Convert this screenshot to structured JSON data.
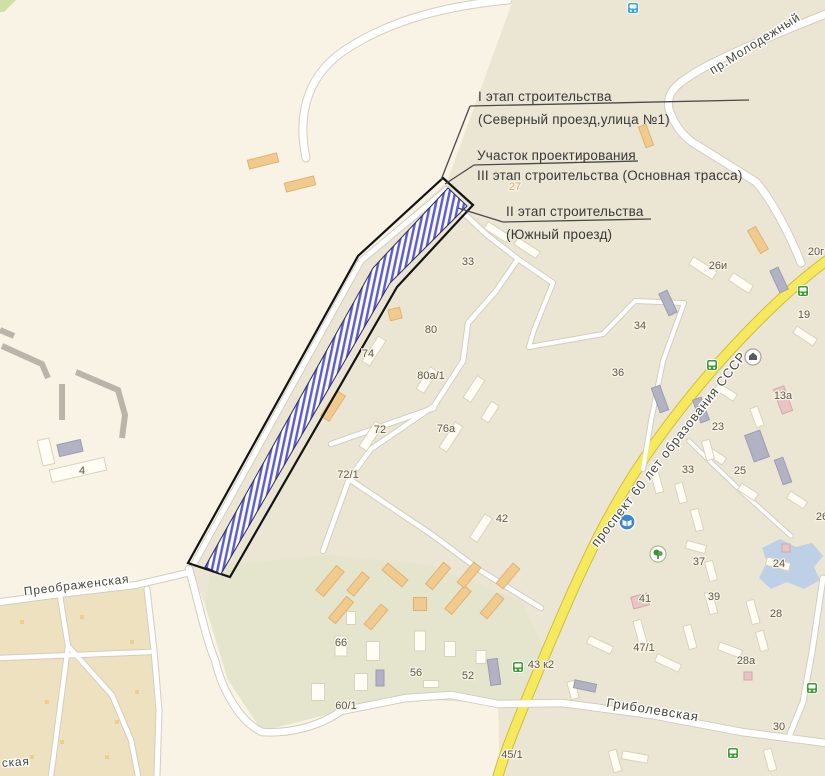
{
  "map": {
    "colors": {
      "background": "#f8f3e4",
      "district_beige": "#ebe6d4",
      "garage_olive": "#e5e4cc",
      "garden_tan": "#eee1c0",
      "road_fill": "#ffffff",
      "road_casing": "#d2cdbf",
      "highway_fill": "#f6e95e",
      "highway_casing": "#cdbd45",
      "pond_blue": "#b9cde8",
      "hatch_blue": "#5c5cd0",
      "corridor_outline": "#141414",
      "green_corner": "#cfe0a6"
    },
    "street_labels": [
      {
        "text": "пр.Молодежный",
        "x": 757,
        "y": 47,
        "rot": -32,
        "size": 12.5
      },
      {
        "text": "проспект 60 лет образования СССР",
        "x": 672,
        "y": 452,
        "rot": -52,
        "size": 13
      },
      {
        "text": "Гриболевская",
        "x": 652,
        "y": 714,
        "rot": 9,
        "size": 13
      },
      {
        "text": "Преображенская",
        "x": 77,
        "y": 589,
        "rot": -7,
        "size": 12
      },
      {
        "text": "ская",
        "x": 16,
        "y": 766,
        "rot": -4,
        "size": 12
      }
    ],
    "building_labels": [
      {
        "text": "27",
        "x": 515,
        "y": 190,
        "faint": true
      },
      {
        "text": "25",
        "x": 580,
        "y": 163,
        "faint": true
      },
      {
        "text": "33",
        "x": 468,
        "y": 265
      },
      {
        "text": "80",
        "x": 431,
        "y": 333
      },
      {
        "text": "74",
        "x": 368,
        "y": 357
      },
      {
        "text": "80а/1",
        "x": 431,
        "y": 379
      },
      {
        "text": "72",
        "x": 380,
        "y": 433
      },
      {
        "text": "76а",
        "x": 446,
        "y": 432
      },
      {
        "text": "72/1",
        "x": 348,
        "y": 478
      },
      {
        "text": "42",
        "x": 502,
        "y": 522
      },
      {
        "text": "4",
        "x": 82,
        "y": 474
      },
      {
        "text": "66",
        "x": 341,
        "y": 646
      },
      {
        "text": "56",
        "x": 416,
        "y": 676
      },
      {
        "text": "52",
        "x": 468,
        "y": 679
      },
      {
        "text": "60/1",
        "x": 346,
        "y": 709
      },
      {
        "text": "45/1",
        "x": 512,
        "y": 758
      },
      {
        "text": "43 к2",
        "x": 541,
        "y": 668
      },
      {
        "text": "47/1",
        "x": 644,
        "y": 651
      },
      {
        "text": "41",
        "x": 645,
        "y": 602
      },
      {
        "text": "39",
        "x": 714,
        "y": 600
      },
      {
        "text": "37",
        "x": 699,
        "y": 565
      },
      {
        "text": "28",
        "x": 776,
        "y": 617
      },
      {
        "text": "28а",
        "x": 746,
        "y": 664
      },
      {
        "text": "30",
        "x": 779,
        "y": 730
      },
      {
        "text": "24",
        "x": 779,
        "y": 567
      },
      {
        "text": "25",
        "x": 740,
        "y": 474
      },
      {
        "text": "33",
        "x": 688,
        "y": 473
      },
      {
        "text": "34",
        "x": 640,
        "y": 329
      },
      {
        "text": "36",
        "x": 618,
        "y": 376
      },
      {
        "text": "23",
        "x": 718,
        "y": 430
      },
      {
        "text": "13а",
        "x": 783,
        "y": 399
      },
      {
        "text": "19",
        "x": 804,
        "y": 318
      },
      {
        "text": "26и",
        "x": 718,
        "y": 269
      },
      {
        "text": "20г",
        "x": 816,
        "y": 255
      },
      {
        "text": "26",
        "x": 822,
        "y": 520
      }
    ],
    "icons": [
      {
        "kind": "bus-blue",
        "x": 633,
        "y": 8
      },
      {
        "kind": "bus-green",
        "x": 803,
        "y": 291
      },
      {
        "kind": "bus-green",
        "x": 712,
        "y": 365
      },
      {
        "kind": "bus-green",
        "x": 518,
        "y": 667
      },
      {
        "kind": "bus-green",
        "x": 812,
        "y": 688
      },
      {
        "kind": "bus-green",
        "x": 733,
        "y": 753
      },
      {
        "kind": "bank",
        "x": 753,
        "y": 357
      },
      {
        "kind": "library",
        "x": 627,
        "y": 522
      },
      {
        "kind": "park",
        "x": 658,
        "y": 554
      }
    ],
    "regions": {
      "district": "513,0 447,182 362,258 190,565 205,605 228,680 262,731 341,711 406,698 498,704 500,776 825,776 825,0",
      "garage": "212,566 330,555 430,565 520,600 545,650 525,700 498,704 406,698 341,711 262,731 228,680 205,605",
      "garden": "0,598 148,588 155,650 160,710 156,776 0,776",
      "green_corner": "0,0 16,0 4,12 0,12",
      "pond": "762,548 780,539 796,547 812,543 823,556 814,567 820,580 804,589 787,582 771,589 759,578 767,562"
    },
    "roads": [
      {
        "d": "M 306,158 C 296,110 310,72 348,48 C 392,20 445,6 508,0",
        "w": 7,
        "t": "w"
      },
      {
        "d": "M 826,14 C 775,34 710,62 690,76 C 674,86 666,95 669,109 C 674,123 680,133 692,142 L 756,182 C 772,200 790,235 801,263",
        "w": 7,
        "t": "w"
      },
      {
        "d": "M 829,259 C 794,284 746,330 703,381 C 664,428 636,468 616,504 C 585,557 552,638 527,698 C 516,725 505,752 498,776",
        "w": 9,
        "t": "y"
      },
      {
        "d": "M 447,189 L 361,261 L 194,564",
        "w": 5,
        "t": "w"
      },
      {
        "d": "M 456,206 L 487,235 L 518,259 L 553,283",
        "w": 4.5,
        "t": "w"
      },
      {
        "d": "M 518,259 L 496,291 L 468,323 L 463,361 L 434,406 L 371,449 L 349,479 L 323,551",
        "w": 4.5,
        "t": "w"
      },
      {
        "d": "M 349,479 L 431,534 L 481,571 L 541,608",
        "w": 4.5,
        "t": "w"
      },
      {
        "d": "M 331,444 L 434,408",
        "w": 4.5,
        "t": "w"
      },
      {
        "d": "M 553,283 L 534,330 L 529,347 L 603,334 L 635,301 L 684,303 M 684,303 L 663,361 L 651,421 L 643,469",
        "w": 4,
        "t": "w"
      },
      {
        "d": "M 262,732 C 290,734 320,726 341,711 L 406,698 L 451,695 L 498,704 L 562,703 L 652,715 L 742,732 L 826,743",
        "w": 6.5,
        "t": "w"
      },
      {
        "d": "M 189,569 C 198,600 206,640 215,660 C 222,690 240,722 262,732",
        "w": 6.5,
        "t": "w"
      },
      {
        "d": "M 0,602 L 68,593 L 136,585 L 187,573",
        "w": 6,
        "t": "w"
      },
      {
        "d": "M 147,589 L 154,650 L 159,710 L 157,776",
        "w": 5,
        "t": "w"
      },
      {
        "d": "M 0,658 L 150,652",
        "w": 4.5,
        "t": "w"
      },
      {
        "d": "M 60,596 L 68,646 L 61,700 L 51,776 M 68,646 L 112,695 L 131,740 L 138,776",
        "w": 4.5,
        "t": "w"
      },
      {
        "d": "M 823,578 L 812,652 L 803,702 L 790,734",
        "w": 5,
        "t": "w"
      },
      {
        "d": "M 689,441 L 741,491 L 791,536",
        "w": 3.5,
        "t": "w"
      }
    ],
    "buildings": [
      [
        263,
        161,
        30,
        9,
        -14,
        "o"
      ],
      [
        300,
        184,
        30,
        9,
        -14,
        "o"
      ],
      [
        395,
        314,
        12,
        11,
        -14,
        "o"
      ],
      [
        333,
        406,
        30,
        10,
        -57,
        "o"
      ],
      [
        330,
        581,
        32,
        10,
        -50,
        "o"
      ],
      [
        341,
        610,
        28,
        9,
        -50,
        "o"
      ],
      [
        358,
        584,
        24,
        9,
        -50,
        "o"
      ],
      [
        376,
        617,
        26,
        9,
        -50,
        "o"
      ],
      [
        395,
        575,
        26,
        9,
        40,
        "o"
      ],
      [
        420,
        604,
        13,
        13,
        0,
        "o"
      ],
      [
        438,
        576,
        28,
        9,
        -50,
        "o"
      ],
      [
        458,
        600,
        30,
        9,
        -50,
        "o"
      ],
      [
        469,
        575,
        26,
        9,
        -50,
        "o"
      ],
      [
        492,
        606,
        26,
        9,
        -50,
        "o"
      ],
      [
        508,
        576,
        26,
        9,
        -50,
        "o"
      ],
      [
        646,
        136,
        8,
        22,
        -20,
        "o"
      ],
      [
        758,
        240,
        9,
        26,
        -30,
        "o"
      ],
      [
        374,
        351,
        30,
        9,
        -57,
        "w"
      ],
      [
        371,
        436,
        30,
        9,
        -57,
        "w"
      ],
      [
        427,
        380,
        26,
        9,
        -57,
        "w"
      ],
      [
        451,
        437,
        30,
        9,
        -57,
        "w"
      ],
      [
        474,
        389,
        26,
        9,
        -57,
        "w"
      ],
      [
        490,
        412,
        20,
        9,
        -57,
        "w"
      ],
      [
        481,
        528,
        28,
        9,
        -57,
        "w"
      ],
      [
        497,
        232,
        26,
        8,
        33,
        "w"
      ],
      [
        527,
        248,
        26,
        8,
        33,
        "w"
      ],
      [
        341,
        646,
        12,
        20,
        0,
        "w"
      ],
      [
        373,
        651,
        13,
        19,
        0,
        "w"
      ],
      [
        361,
        682,
        13,
        17,
        0,
        "w"
      ],
      [
        318,
        692,
        13,
        17,
        0,
        "w"
      ],
      [
        420,
        641,
        11,
        20,
        0,
        "w"
      ],
      [
        450,
        649,
        11,
        15,
        0,
        "w"
      ],
      [
        481,
        657,
        10,
        13,
        0,
        "w"
      ],
      [
        431,
        684,
        15,
        7,
        0,
        "w"
      ],
      [
        351,
        618,
        9,
        13,
        0,
        "w"
      ],
      [
        703,
        268,
        28,
        9,
        33,
        "w"
      ],
      [
        741,
        283,
        24,
        9,
        33,
        "w"
      ],
      [
        805,
        336,
        24,
        8,
        33,
        "w"
      ],
      [
        726,
        392,
        22,
        8,
        33,
        "w"
      ],
      [
        757,
        417,
        8,
        20,
        -20,
        "w"
      ],
      [
        716,
        456,
        20,
        8,
        33,
        "w"
      ],
      [
        748,
        492,
        20,
        8,
        33,
        "w"
      ],
      [
        797,
        500,
        20,
        8,
        33,
        "w"
      ],
      [
        708,
        450,
        8,
        20,
        -15,
        "w"
      ],
      [
        657,
        482,
        8,
        22,
        -15,
        "w"
      ],
      [
        681,
        493,
        8,
        20,
        -15,
        "w"
      ],
      [
        697,
        520,
        8,
        22,
        -15,
        "w"
      ],
      [
        696,
        547,
        20,
        8,
        15,
        "w"
      ],
      [
        711,
        571,
        8,
        20,
        -15,
        "w"
      ],
      [
        711,
        603,
        8,
        22,
        -15,
        "w"
      ],
      [
        753,
        612,
        8,
        24,
        -15,
        "w"
      ],
      [
        778,
        564,
        24,
        8,
        15,
        "w"
      ],
      [
        690,
        637,
        8,
        24,
        -15,
        "w"
      ],
      [
        730,
        650,
        24,
        8,
        20,
        "w"
      ],
      [
        762,
        641,
        8,
        20,
        -15,
        "w"
      ],
      [
        600,
        645,
        26,
        8,
        25,
        "w"
      ],
      [
        640,
        632,
        8,
        24,
        -15,
        "w"
      ],
      [
        668,
        663,
        26,
        8,
        25,
        "w"
      ],
      [
        770,
        760,
        8,
        22,
        -15,
        "w"
      ],
      [
        615,
        761,
        8,
        22,
        -15,
        "w"
      ],
      [
        573,
        690,
        8,
        18,
        -15,
        "w"
      ],
      [
        635,
        757,
        26,
        8,
        10,
        "w"
      ],
      [
        78,
        470,
        56,
        13,
        -13,
        "w"
      ],
      [
        46,
        452,
        12,
        26,
        -13,
        "w"
      ],
      [
        668,
        303,
        9,
        24,
        -25,
        "g"
      ],
      [
        779,
        280,
        9,
        24,
        -25,
        "g"
      ],
      [
        660,
        399,
        9,
        26,
        -20,
        "g"
      ],
      [
        701,
        410,
        9,
        24,
        -20,
        "g"
      ],
      [
        757,
        446,
        16,
        28,
        -20,
        "g"
      ],
      [
        783,
        471,
        9,
        26,
        -20,
        "g"
      ],
      [
        585,
        686,
        22,
        8,
        12,
        "g"
      ],
      [
        380,
        678,
        8,
        16,
        0,
        "g"
      ],
      [
        494,
        672,
        10,
        26,
        -8,
        "g"
      ],
      [
        70,
        448,
        24,
        12,
        -13,
        "g"
      ],
      [
        640,
        601,
        16,
        12,
        -15,
        "p"
      ],
      [
        783,
        400,
        11,
        26,
        -20,
        "p"
      ],
      [
        786,
        548,
        8,
        8,
        0,
        "p"
      ],
      [
        748,
        676,
        8,
        8,
        0,
        "p"
      ]
    ],
    "garden_specks": [
      [
        20,
        620
      ],
      [
        45,
        700
      ],
      [
        90,
        670
      ],
      [
        115,
        720
      ],
      [
        60,
        740
      ],
      [
        130,
        640
      ],
      [
        30,
        755
      ],
      [
        105,
        755
      ],
      [
        80,
        615
      ],
      [
        135,
        690
      ]
    ],
    "ruin_strokes": [
      "M 2,346 L 42,364 L 48,378",
      "M 62,384 L 62,420",
      "M 76,372 L 118,390 L 125,415 L 122,438",
      "M 0,330 L 14,336"
    ]
  },
  "corridor": {
    "outer_points": "443,178 473,205 397,287 230,577 188,563 358,256",
    "hatch_points": "448,188 467,206 390,283 221,574 205,567 373,268"
  },
  "annotations": {
    "stage1": {
      "title": "I этап строительства",
      "subtitle": "(Северный проезд,улица №1)"
    },
    "design": {
      "line1": "Участок проектирования",
      "line2": "III этап строительства (Основная трасса)"
    },
    "stage2": {
      "title": "II этап строительства",
      "subtitle": "(Южный проезд)"
    }
  }
}
